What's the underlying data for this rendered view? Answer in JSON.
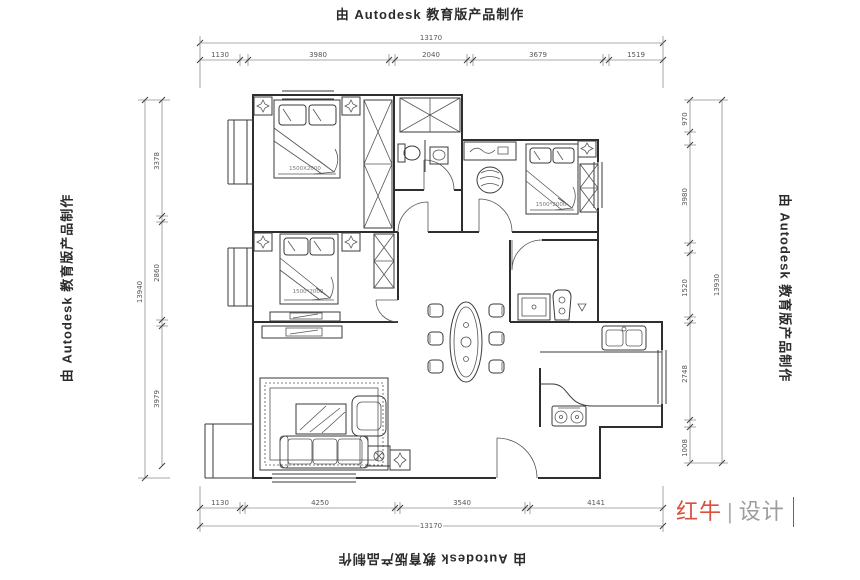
{
  "watermark": {
    "text": "由 Autodesk 教育版产品制作"
  },
  "logo": {
    "brand": "红牛",
    "divider": "|",
    "studio": "设计",
    "brand_color": "#d9503e",
    "studio_color": "#9c9c9c"
  },
  "dimensions": {
    "top": {
      "total": "13170",
      "segments": [
        "1130",
        "3980",
        "2040",
        "3679",
        "1519"
      ]
    },
    "bottom": {
      "total": "13170",
      "segments": [
        "1130",
        "4250",
        "3540",
        "4141"
      ]
    },
    "left": {
      "total": "13940",
      "segments": [
        "3378",
        "2860",
        "3979"
      ]
    },
    "right": {
      "total": "13930",
      "segments": [
        "970",
        "3980",
        "1520",
        "2748",
        "1008"
      ]
    }
  },
  "furniture_labels": {
    "bed_master": "1500X2000",
    "bed_second": "1500*2000",
    "bed_third": "1500*2000"
  },
  "colors": {
    "wall_line": "#2e2e2e",
    "dimension_line": "#8f8f8f",
    "background": "#ffffff"
  }
}
